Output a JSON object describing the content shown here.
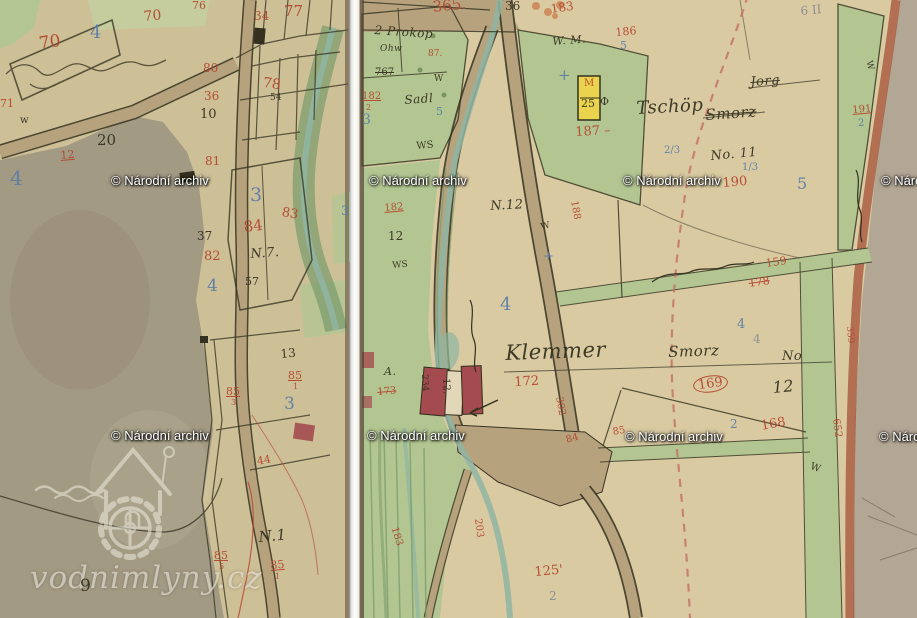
{
  "watermarks": {
    "archive_text": "© Národní archiv",
    "site_text": "vodnimlyny.cz",
    "archive_positions": [
      {
        "x": 111,
        "y": 173
      },
      {
        "x": 369,
        "y": 173
      },
      {
        "x": 623,
        "y": 173
      },
      {
        "x": 881,
        "y": 173
      },
      {
        "x": 111,
        "y": 428
      },
      {
        "x": 367,
        "y": 428
      },
      {
        "x": 625,
        "y": 429
      },
      {
        "x": 879,
        "y": 429
      }
    ]
  },
  "palette": {
    "red": "#b5452e",
    "blue": "#5a7da8",
    "ink": "#33301f",
    "pencil": "#8a8a92",
    "green": "#b3c692",
    "green2": "#c2d3a2",
    "teal": "#8fb5a3",
    "road": "#b6a37d",
    "grey": "#a39a84",
    "carmine": "#a34b4e",
    "yellow": "#e9d34f",
    "roadred": "#a8573e",
    "dashred": "#c47467",
    "mauve": "#b2a694",
    "stripgreen": "#7d9e6d",
    "logo": "#efeadc"
  },
  "labels": [
    {
      "p": "L",
      "t": "70",
      "x": 38,
      "y": 36,
      "c": "red",
      "s": 17,
      "r": -8
    },
    {
      "p": "L",
      "t": "4",
      "x": 90,
      "y": 24,
      "c": "blue",
      "s": 18
    },
    {
      "p": "L",
      "t": "70",
      "x": 143,
      "y": 10,
      "c": "red",
      "s": 14,
      "r": -5
    },
    {
      "p": "L",
      "t": "76",
      "x": 192,
      "y": 0,
      "c": "red",
      "s": 11
    },
    {
      "p": "L",
      "t": "34",
      "x": 254,
      "y": 10,
      "c": "red",
      "s": 12
    },
    {
      "p": "L",
      "t": "77",
      "x": 284,
      "y": 4,
      "c": "red",
      "s": 15
    },
    {
      "p": "L",
      "t": "80",
      "x": 203,
      "y": 62,
      "c": "red",
      "s": 12
    },
    {
      "p": "L",
      "t": "78",
      "x": 264,
      "y": 76,
      "c": "red",
      "s": 14,
      "r": 8
    },
    {
      "p": "L",
      "t": "54",
      "x": 270,
      "y": 94,
      "c": "ink",
      "s": 9
    },
    {
      "p": "L",
      "t": "36",
      "x": 204,
      "y": 90,
      "c": "red",
      "s": 12
    },
    {
      "p": "L",
      "t": "10",
      "x": 200,
      "y": 108,
      "c": "ink",
      "s": 13
    },
    {
      "p": "L",
      "t": "w",
      "x": 20,
      "y": 116,
      "c": "ink",
      "s": 10
    },
    {
      "p": "L",
      "t": "71",
      "x": 0,
      "y": 98,
      "c": "red",
      "s": 11
    },
    {
      "p": "L",
      "t": "20",
      "x": 97,
      "y": 133,
      "c": "ink",
      "s": 15
    },
    {
      "p": "L",
      "t": "12",
      "x": 60,
      "y": 150,
      "c": "red",
      "s": 11,
      "r": -5,
      "d": "under"
    },
    {
      "p": "L",
      "t": "4",
      "x": 10,
      "y": 168,
      "c": "blue",
      "s": 20
    },
    {
      "p": "L",
      "t": "81",
      "x": 205,
      "y": 155,
      "c": "red",
      "s": 12
    },
    {
      "p": "L",
      "t": "3",
      "x": 250,
      "y": 186,
      "c": "blue",
      "s": 19
    },
    {
      "p": "L",
      "t": "3",
      "x": 341,
      "y": 205,
      "c": "blue",
      "s": 13
    },
    {
      "p": "L",
      "t": "84",
      "x": 243,
      "y": 220,
      "c": "red",
      "s": 15,
      "r": -6
    },
    {
      "p": "L",
      "t": "83",
      "x": 283,
      "y": 206,
      "c": "red",
      "s": 13,
      "r": 10
    },
    {
      "p": "L",
      "t": "37",
      "x": 197,
      "y": 230,
      "c": "ink",
      "s": 12
    },
    {
      "p": "L",
      "t": "N.7.",
      "x": 250,
      "y": 248,
      "c": "ink",
      "s": 13,
      "r": -4,
      "f": "script"
    },
    {
      "p": "L",
      "t": "82",
      "x": 204,
      "y": 250,
      "c": "red",
      "s": 13
    },
    {
      "p": "L",
      "t": "57",
      "x": 245,
      "y": 276,
      "c": "ink",
      "s": 11
    },
    {
      "p": "L",
      "t": "4",
      "x": 207,
      "y": 278,
      "c": "blue",
      "s": 17
    },
    {
      "p": "L",
      "t": "13",
      "x": 280,
      "y": 348,
      "c": "ink",
      "s": 12,
      "r": -5
    },
    {
      "p": "L",
      "t": "85",
      "x": 288,
      "y": 370,
      "c": "red",
      "s": 11,
      "d": "under"
    },
    {
      "p": "L",
      "t": "1",
      "x": 293,
      "y": 383,
      "c": "red",
      "s": 8
    },
    {
      "p": "L",
      "t": "85",
      "x": 226,
      "y": 386,
      "c": "red",
      "s": 11,
      "d": "under"
    },
    {
      "p": "L",
      "t": "3",
      "x": 231,
      "y": 399,
      "c": "red",
      "s": 8
    },
    {
      "p": "L",
      "t": "3",
      "x": 284,
      "y": 396,
      "c": "blue",
      "s": 17
    },
    {
      "p": "L",
      "t": "44",
      "x": 256,
      "y": 456,
      "c": "red",
      "s": 11,
      "r": -10
    },
    {
      "p": "L",
      "t": "N.1",
      "x": 258,
      "y": 530,
      "c": "ink",
      "s": 15,
      "r": -5,
      "f": "script"
    },
    {
      "p": "L",
      "t": "85",
      "x": 214,
      "y": 550,
      "c": "red",
      "s": 11,
      "d": "under"
    },
    {
      "p": "L",
      "t": "5",
      "x": 219,
      "y": 563,
      "c": "red",
      "s": 8
    },
    {
      "p": "L",
      "t": "85",
      "x": 270,
      "y": 560,
      "c": "red",
      "s": 11,
      "r": -5,
      "d": "under"
    },
    {
      "p": "L",
      "t": "1",
      "x": 275,
      "y": 573,
      "c": "red",
      "s": 8
    },
    {
      "p": "L",
      "t": "9",
      "x": 80,
      "y": 578,
      "c": "ink",
      "s": 17
    },
    {
      "p": "R",
      "t": "365.",
      "x": 432,
      "y": 0,
      "c": "red",
      "s": 15,
      "r": -6
    },
    {
      "p": "R",
      "t": "36",
      "x": 505,
      "y": 0,
      "c": "ink",
      "s": 12
    },
    {
      "p": "R",
      "t": "183",
      "x": 550,
      "y": 3,
      "c": "red",
      "s": 12,
      "r": -8
    },
    {
      "p": "R",
      "t": "2 Prokop",
      "x": 375,
      "y": 24,
      "c": "ink",
      "s": 12,
      "r": 4,
      "f": "script"
    },
    {
      "p": "R",
      "t": "Ohw",
      "x": 380,
      "y": 45,
      "c": "ink",
      "s": 9,
      "f": "script"
    },
    {
      "p": "R",
      "t": "87.",
      "x": 428,
      "y": 50,
      "c": "red",
      "s": 9
    },
    {
      "p": "R",
      "t": "767",
      "x": 375,
      "y": 68,
      "c": "ink",
      "s": 10,
      "d": "strike"
    },
    {
      "p": "R",
      "t": "182",
      "x": 362,
      "y": 92,
      "c": "red",
      "s": 10,
      "d": "under"
    },
    {
      "p": "R",
      "t": "2",
      "x": 366,
      "y": 104,
      "c": "red",
      "s": 8
    },
    {
      "p": "R",
      "t": "3",
      "x": 362,
      "y": 113,
      "c": "blue",
      "s": 14
    },
    {
      "p": "R",
      "t": "Sadl",
      "x": 404,
      "y": 94,
      "c": "ink",
      "s": 12,
      "r": -4,
      "f": "script"
    },
    {
      "p": "R",
      "t": "W",
      "x": 434,
      "y": 75,
      "c": "ink",
      "s": 9
    },
    {
      "p": "R",
      "t": "5",
      "x": 436,
      "y": 106,
      "c": "blue",
      "s": 11
    },
    {
      "p": "R",
      "t": "WS",
      "x": 416,
      "y": 142,
      "c": "ink",
      "s": 10,
      "r": -5
    },
    {
      "p": "R",
      "t": "W. M.",
      "x": 552,
      "y": 36,
      "c": "ink",
      "s": 11,
      "r": -4,
      "f": "script"
    },
    {
      "p": "R",
      "t": "+",
      "x": 558,
      "y": 68,
      "c": "blue",
      "s": 15
    },
    {
      "p": "R",
      "t": "Φ",
      "x": 600,
      "y": 96,
      "c": "ink",
      "s": 11
    },
    {
      "p": "R",
      "t": "186",
      "x": 615,
      "y": 27,
      "c": "red",
      "s": 11,
      "r": -5
    },
    {
      "p": "R",
      "t": "5",
      "x": 620,
      "y": 40,
      "c": "blue",
      "s": 11
    },
    {
      "p": "R",
      "t": "187 –",
      "x": 575,
      "y": 126,
      "c": "red",
      "s": 13,
      "r": -3
    },
    {
      "p": "R",
      "t": "188",
      "x": 578,
      "y": 200,
      "c": "red",
      "s": 10,
      "r": 80
    },
    {
      "p": "R",
      "t": "182",
      "x": 384,
      "y": 204,
      "c": "red",
      "s": 10,
      "r": -5,
      "d": "under"
    },
    {
      "p": "R",
      "t": "N.12",
      "x": 490,
      "y": 200,
      "c": "ink",
      "s": 13,
      "r": -3,
      "f": "script"
    },
    {
      "p": "R",
      "t": "12",
      "x": 388,
      "y": 230,
      "c": "ink",
      "s": 12
    },
    {
      "p": "R",
      "t": "WS",
      "x": 392,
      "y": 262,
      "c": "ink",
      "s": 9,
      "r": -5
    },
    {
      "p": "R",
      "t": "W",
      "x": 540,
      "y": 224,
      "c": "ink",
      "s": 9,
      "r": -15
    },
    {
      "p": "R",
      "t": "+",
      "x": 543,
      "y": 250,
      "c": "blue",
      "s": 13
    },
    {
      "p": "R",
      "t": "4",
      "x": 500,
      "y": 296,
      "c": "blue",
      "s": 18
    },
    {
      "p": "R",
      "t": "Klemmer",
      "x": 505,
      "y": 343,
      "c": "ink",
      "s": 21,
      "r": -2,
      "f": "script"
    },
    {
      "p": "R",
      "t": "Smorz",
      "x": 668,
      "y": 345,
      "c": "ink",
      "s": 15,
      "r": -2,
      "f": "script"
    },
    {
      "p": "R",
      "t": "No",
      "x": 782,
      "y": 350,
      "c": "ink",
      "s": 13,
      "f": "script"
    },
    {
      "p": "R",
      "t": "12",
      "x": 772,
      "y": 380,
      "c": "ink",
      "s": 16,
      "r": -5,
      "f": "script"
    },
    {
      "p": "R",
      "t": "172",
      "x": 514,
      "y": 376,
      "c": "red",
      "s": 13,
      "r": -3
    },
    {
      "p": "R",
      "t": "169",
      "x": 692,
      "y": 378,
      "c": "red",
      "s": 13,
      "r": -8,
      "d": "circle"
    },
    {
      "p": "R",
      "t": "168",
      "x": 760,
      "y": 420,
      "c": "red",
      "s": 13,
      "r": -10
    },
    {
      "p": "R",
      "t": "2",
      "x": 730,
      "y": 418,
      "c": "blue",
      "s": 12
    },
    {
      "p": "R",
      "t": "W",
      "x": 812,
      "y": 462,
      "c": "ink",
      "s": 10,
      "r": 20
    },
    {
      "p": "R",
      "t": "4",
      "x": 737,
      "y": 318,
      "c": "blue",
      "s": 13
    },
    {
      "p": "R",
      "t": "4",
      "x": 753,
      "y": 333,
      "c": "grey",
      "s": 12
    },
    {
      "p": "R",
      "t": "159",
      "x": 765,
      "y": 258,
      "c": "red",
      "s": 11,
      "r": -8
    },
    {
      "p": "R",
      "t": "178",
      "x": 748,
      "y": 278,
      "c": "red",
      "s": 11,
      "r": -8,
      "d": "strike"
    },
    {
      "p": "R",
      "t": "Jorg",
      "x": 750,
      "y": 76,
      "c": "ink",
      "s": 13,
      "r": -4,
      "f": "script",
      "d": "strike"
    },
    {
      "p": "R",
      "t": "Tschöp",
      "x": 636,
      "y": 100,
      "c": "ink",
      "s": 18,
      "r": -3,
      "f": "script"
    },
    {
      "p": "R",
      "t": "Smorz",
      "x": 705,
      "y": 108,
      "c": "ink",
      "s": 15,
      "r": -4,
      "f": "script",
      "d": "strike"
    },
    {
      "p": "R",
      "t": "No. 11",
      "x": 710,
      "y": 150,
      "c": "ink",
      "s": 13,
      "r": -5,
      "f": "script"
    },
    {
      "p": "R",
      "t": "2/3",
      "x": 664,
      "y": 146,
      "c": "blue",
      "s": 10
    },
    {
      "p": "R",
      "t": "1/3",
      "x": 742,
      "y": 163,
      "c": "blue",
      "s": 10
    },
    {
      "p": "R",
      "t": "190",
      "x": 722,
      "y": 177,
      "c": "red",
      "s": 13,
      "r": -5
    },
    {
      "p": "R",
      "t": "5",
      "x": 797,
      "y": 176,
      "c": "blue",
      "s": 16
    },
    {
      "p": "R",
      "t": "6 II",
      "x": 800,
      "y": 5,
      "c": "grey",
      "s": 12,
      "r": -5
    },
    {
      "p": "R",
      "t": "191",
      "x": 852,
      "y": 106,
      "c": "red",
      "s": 10,
      "r": -5,
      "d": "under"
    },
    {
      "p": "R",
      "t": "2",
      "x": 858,
      "y": 119,
      "c": "blue",
      "s": 10
    },
    {
      "p": "R",
      "t": "W",
      "x": 872,
      "y": 60,
      "c": "ink",
      "s": 9,
      "r": 75
    },
    {
      "p": "R",
      "t": "652",
      "x": 840,
      "y": 418,
      "c": "red",
      "s": 10,
      "r": 82
    },
    {
      "p": "R",
      "t": "359",
      "x": 853,
      "y": 326,
      "c": "red",
      "s": 9,
      "r": 85
    },
    {
      "p": "R",
      "t": "302",
      "x": 563,
      "y": 396,
      "c": "red",
      "s": 10,
      "r": 80
    },
    {
      "p": "R",
      "t": "203",
      "x": 482,
      "y": 518,
      "c": "red",
      "s": 10,
      "r": 83
    },
    {
      "p": "R",
      "t": "183",
      "x": 398,
      "y": 526,
      "c": "red",
      "s": 10,
      "r": 72
    },
    {
      "p": "R",
      "t": "125'",
      "x": 534,
      "y": 566,
      "c": "red",
      "s": 13,
      "r": -5
    },
    {
      "p": "R",
      "t": "2",
      "x": 549,
      "y": 590,
      "c": "grey",
      "s": 12
    },
    {
      "p": "R",
      "t": "84",
      "x": 565,
      "y": 436,
      "c": "red",
      "s": 10,
      "r": -15
    },
    {
      "p": "R",
      "t": "85",
      "x": 612,
      "y": 428,
      "c": "red",
      "s": 10,
      "r": -10
    },
    {
      "p": "R",
      "t": "A.",
      "x": 384,
      "y": 366,
      "c": "ink",
      "s": 11,
      "f": "script"
    },
    {
      "p": "R",
      "t": "173",
      "x": 377,
      "y": 388,
      "c": "red",
      "s": 10,
      "r": -5,
      "d": "strike"
    },
    {
      "p": "R",
      "t": "234",
      "x": 428,
      "y": 374,
      "c": "ink",
      "s": 9,
      "r": 87
    },
    {
      "p": "R",
      "t": "12.",
      "x": 450,
      "y": 378,
      "c": "ink",
      "s": 10,
      "r": 87
    },
    {
      "p": "R",
      "t": "M",
      "x": 584,
      "y": 79,
      "c": "red",
      "s": 10
    },
    {
      "p": "R",
      "t": "25",
      "x": 581,
      "y": 98,
      "c": "ink",
      "s": 11
    }
  ]
}
